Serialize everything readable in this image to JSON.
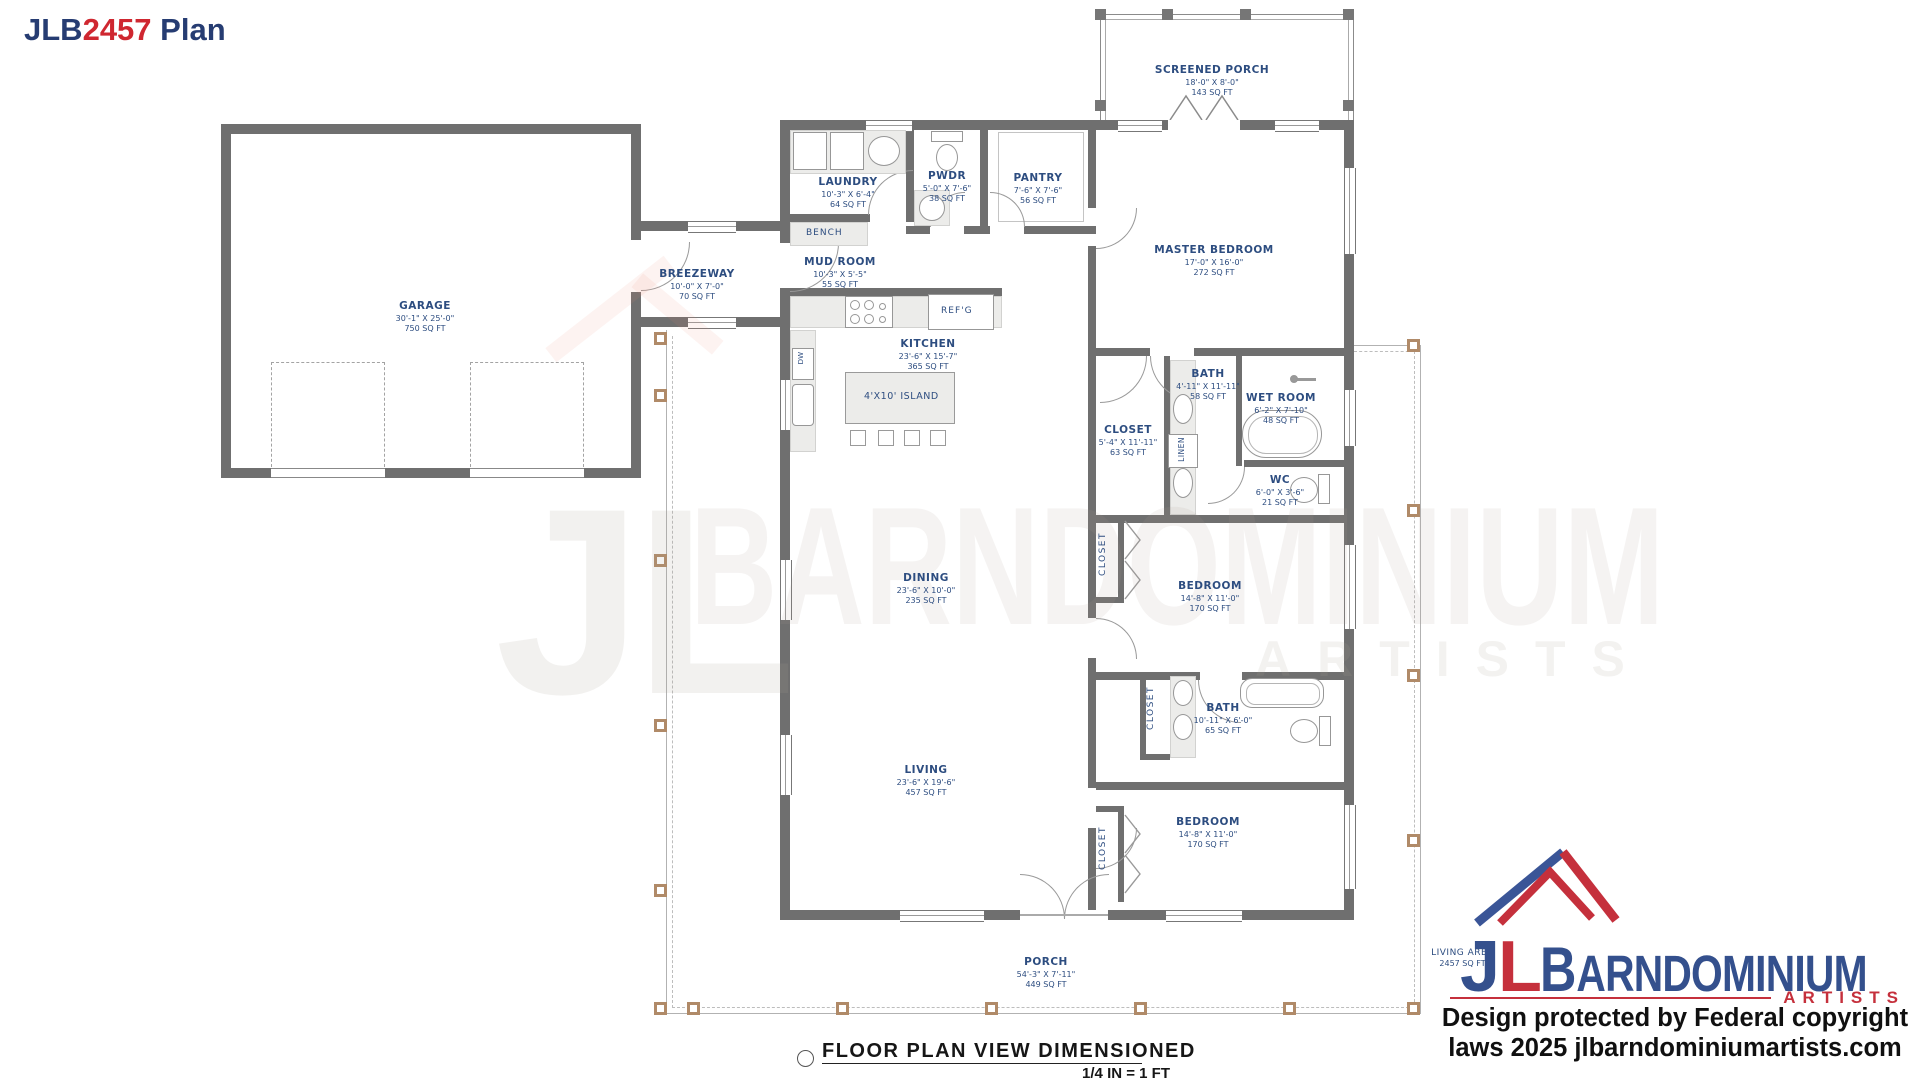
{
  "title": {
    "part1": "JLB",
    "part2": "2457",
    "part3": " Plan"
  },
  "colors": {
    "navy": "#263c72",
    "red": "#cf2730",
    "label_blue": "#2d4d80",
    "wall_gray": "#6f6f6f",
    "post_tan": "#b08a68"
  },
  "rooms": {
    "garage": {
      "name": "GARAGE",
      "dims": "30'-1\" X 25'-0\"",
      "area": "750 SQ FT"
    },
    "breezeway": {
      "name": "BREEZEWAY",
      "dims": "10'-0\" X 7'-0\"",
      "area": "70 SQ FT"
    },
    "laundry": {
      "name": "LAUNDRY",
      "dims": "10'-3\" X 6'-4\"",
      "area": "64 SQ FT"
    },
    "mud_room": {
      "name": "MUD ROOM",
      "dims": "10'-3\" X 5'-5\"",
      "area": "55 SQ FT"
    },
    "pwdr": {
      "name": "PWDR",
      "dims": "5'-0\" X 7'-6\"",
      "area": "38 SQ FT"
    },
    "pantry": {
      "name": "PANTRY",
      "dims": "7'-6\" X 7'-6\"",
      "area": "56 SQ FT"
    },
    "screened_porch": {
      "name": "SCREENED PORCH",
      "dims": "18'-0\" X 8'-0\"",
      "area": "143 SQ FT"
    },
    "master_bedroom": {
      "name": "MASTER BEDROOM",
      "dims": "17'-0\" X 16'-0\"",
      "area": "272 SQ FT"
    },
    "kitchen": {
      "name": "KITCHEN",
      "dims": "23'-6\" X 15'-7\"",
      "area": "365 SQ FT"
    },
    "master_bath": {
      "name": "BATH",
      "dims": "4'-11\" X 11'-11\"",
      "area": "58 SQ FT"
    },
    "wet_room": {
      "name": "WET ROOM",
      "dims": "6'-2\" X 7'-10\"",
      "area": "48 SQ FT"
    },
    "master_closet": {
      "name": "CLOSET",
      "dims": "5'-4\" X 11'-11\"",
      "area": "63 SQ FT"
    },
    "wc": {
      "name": "WC",
      "dims": "6'-0\" X 3'-6\"",
      "area": "21 SQ FT"
    },
    "dining": {
      "name": "DINING",
      "dims": "23'-6\" X 10'-0\"",
      "area": "235 SQ FT"
    },
    "living": {
      "name": "LIVING",
      "dims": "23'-6\" X 19'-6\"",
      "area": "457 SQ FT"
    },
    "bedroom1": {
      "name": "BEDROOM",
      "dims": "14'-8\" X 11'-0\"",
      "area": "170 SQ FT"
    },
    "bath2": {
      "name": "BATH",
      "dims": "10'-11\" X 6'-0\"",
      "area": "65 SQ FT"
    },
    "bedroom2": {
      "name": "BEDROOM",
      "dims": "14'-8\" X 11'-0\"",
      "area": "170 SQ FT"
    },
    "porch": {
      "name": "PORCH",
      "dims": "54'-3\" X 7'-11\"",
      "area": "449 SQ FT"
    }
  },
  "fixtures": {
    "bench": "BENCH",
    "island": "4'X10' ISLAND",
    "refg": "REF'G",
    "linen": "LINEN",
    "closet": "CLOSET",
    "dw": "DW"
  },
  "annotations": {
    "living_area": "LIVING AREA",
    "living_area_value": "2457 SQ FT"
  },
  "caption": {
    "title": "FLOOR PLAN VIEW DIMENSIONED",
    "scale": "1/4 IN = 1 FT"
  },
  "watermark": {
    "jl": "JL",
    "barndominium": "BARNDOMINIUM",
    "artists": "ARTISTS"
  },
  "logo": {
    "j": "J",
    "l": "L",
    "b": "B",
    "rest": "ARNDOMINIUM",
    "artists": "ARTISTS",
    "line1": "Design protected by Federal copyright",
    "line2": "laws 2025 jlbarndominiumartists.com"
  }
}
